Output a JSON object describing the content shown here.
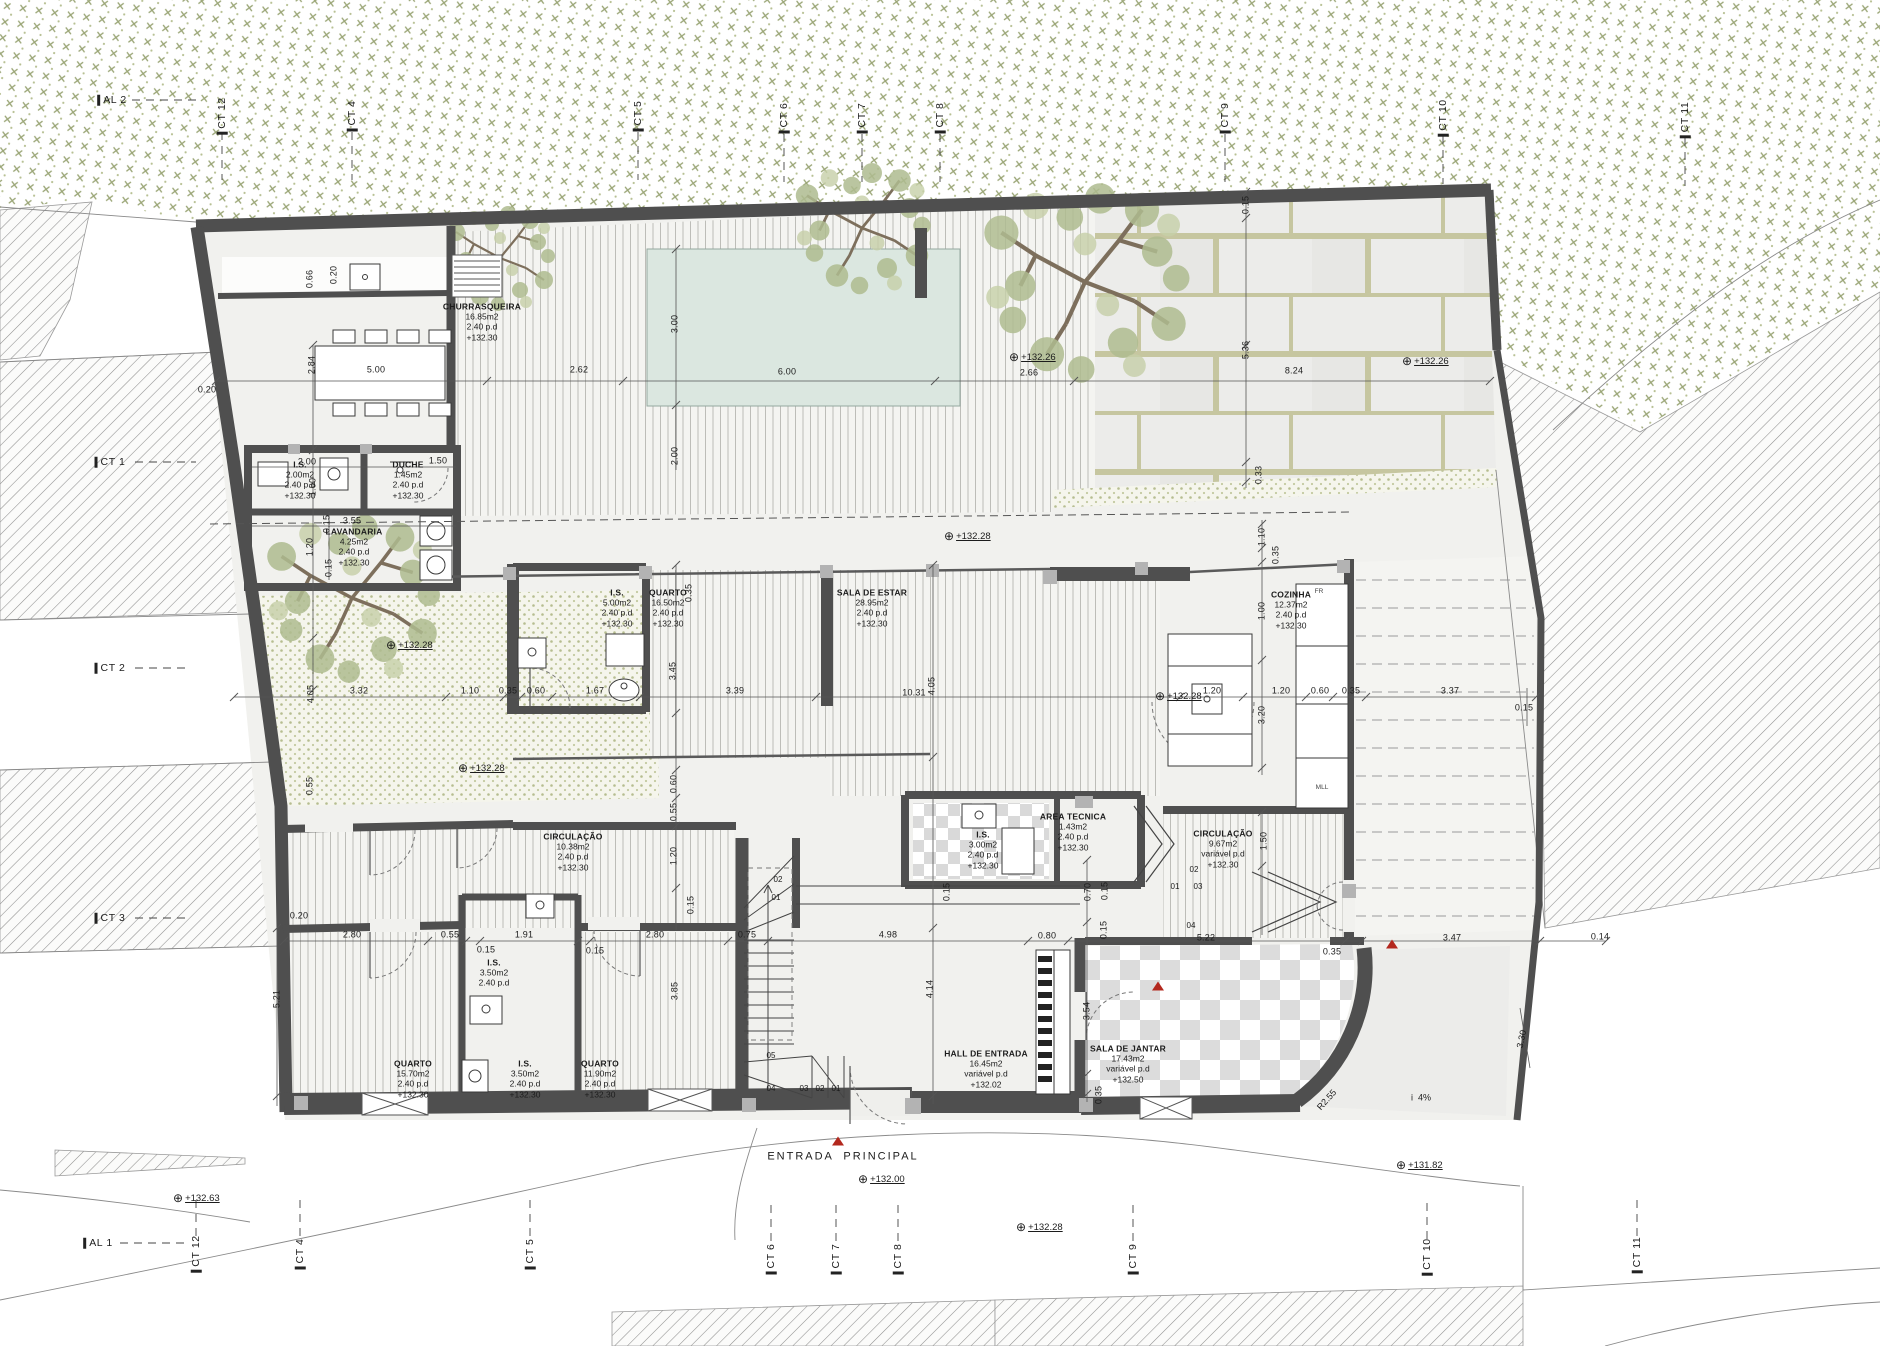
{
  "title": "Planta Piso 0 - habitação unifamiliar",
  "colors": {
    "wall": "#4f4f4f",
    "pool": "#dbe7e0",
    "leaf": "#afbc90",
    "accent_red": "#b3281e"
  },
  "rooms": [
    {
      "n": "CHURRASQUEIRA",
      "a": "16.85m2",
      "h": "2.40  p.d",
      "l": "+132.30",
      "x": 482,
      "y": 322
    },
    {
      "n": "I.S.",
      "a": "2.00m2",
      "h": "2.40  p.d",
      "l": "+132.30",
      "x": 300,
      "y": 480
    },
    {
      "n": "DUCHE",
      "a": "1.45m2",
      "h": "2.40  p.d",
      "l": "+132.30",
      "x": 408,
      "y": 480
    },
    {
      "n": "LAVANDARIA",
      "a": "4.25m2",
      "h": "2.40  p.d",
      "l": "+132.30",
      "x": 354,
      "y": 547
    },
    {
      "n": "I.S.",
      "a": "5.00m2",
      "h": "2.40  p.d",
      "l": "+132.30",
      "x": 617,
      "y": 608
    },
    {
      "n": "QUARTO",
      "a": "16.50m2",
      "h": "2.40  p.d",
      "l": "+132.30",
      "x": 668,
      "y": 608
    },
    {
      "n": "SALA DE ESTAR",
      "a": "28.95m2",
      "h": "2.40  p.d",
      "l": "+132.30",
      "x": 872,
      "y": 608
    },
    {
      "n": "COZINHA",
      "a": "12.37m2",
      "h": "2.40  p.d",
      "l": "+132.30",
      "x": 1291,
      "y": 610
    },
    {
      "n": "CIRCULAÇÃO",
      "a": "10.38m2",
      "h": "2.40  p.d",
      "l": "+132.30",
      "x": 573,
      "y": 852
    },
    {
      "n": "I.S.",
      "a": "3.00m2",
      "h": "2.40  p.d",
      "l": "+132.30",
      "x": 983,
      "y": 850
    },
    {
      "n": "AREA TECNICA",
      "a": "1.43m2",
      "h": "2.40  p.d",
      "l": "+132.30",
      "x": 1073,
      "y": 832
    },
    {
      "n": "CIRCULAÇÃO",
      "a": "9.67m2",
      "h": "variável  p.d",
      "l": "+132.30",
      "x": 1223,
      "y": 849
    },
    {
      "n": "QUARTO",
      "a": "15.70m2",
      "h": "2.40  p.d",
      "l": "+132.30",
      "x": 413,
      "y": 1079
    },
    {
      "n": "I.S.",
      "a": "3.50m2",
      "h": "2.40  p.d",
      "l": "+132.30",
      "x": 525,
      "y": 1079
    },
    {
      "n": "I.S.",
      "a": "3.50m2",
      "h": "2.40  p.d",
      "l": "",
      "x": 494,
      "y": 973
    },
    {
      "n": "QUARTO",
      "a": "11.90m2",
      "h": "2.40  p.d",
      "l": "+132.30",
      "x": 600,
      "y": 1079
    },
    {
      "n": "HALL DE ENTRADA",
      "a": "16.45m2",
      "h": "variável  p.d",
      "l": "+132.02",
      "x": 986,
      "y": 1069
    },
    {
      "n": "SALA DE JANTAR",
      "a": "17.43m2",
      "h": "variável  p.d",
      "l": "+132.50",
      "x": 1128,
      "y": 1064
    }
  ],
  "dims": [
    {
      "t": "0.20",
      "x": 207,
      "y": 390
    },
    {
      "t": "5.00",
      "x": 376,
      "y": 370
    },
    {
      "t": "2.62",
      "x": 579,
      "y": 370
    },
    {
      "t": "6.00",
      "x": 787,
      "y": 372
    },
    {
      "t": "2.66",
      "x": 1029,
      "y": 373
    },
    {
      "t": "8.24",
      "x": 1294,
      "y": 371
    },
    {
      "t": "2.84",
      "x": 312,
      "y": 365,
      "r": -90
    },
    {
      "t": "0.66",
      "x": 310,
      "y": 279,
      "r": -90
    },
    {
      "t": "0.20",
      "x": 334,
      "y": 275,
      "r": -90
    },
    {
      "t": "3.00",
      "x": 675,
      "y": 324,
      "r": -90
    },
    {
      "t": "2.00",
      "x": 675,
      "y": 456,
      "r": -90
    },
    {
      "t": "5.36",
      "x": 1246,
      "y": 350,
      "r": -90
    },
    {
      "t": "0.33",
      "x": 1259,
      "y": 475,
      "r": -90
    },
    {
      "t": "0.15",
      "x": 1246,
      "y": 205,
      "r": -90
    },
    {
      "t": "2.00",
      "x": 307,
      "y": 462
    },
    {
      "t": "1.50",
      "x": 438,
      "y": 461
    },
    {
      "t": "1.00",
      "x": 313,
      "y": 487,
      "r": -90
    },
    {
      "t": "3.55",
      "x": 352,
      "y": 521
    },
    {
      "t": "0.15",
      "x": 327,
      "y": 524,
      "r": -90
    },
    {
      "t": "1.20",
      "x": 310,
      "y": 547,
      "r": -90
    },
    {
      "t": "0.15",
      "x": 329,
      "y": 568,
      "r": -90
    },
    {
      "t": "3.32",
      "x": 359,
      "y": 691
    },
    {
      "t": "1.10",
      "x": 470,
      "y": 691
    },
    {
      "t": "0.35",
      "x": 508,
      "y": 691
    },
    {
      "t": "0.60",
      "x": 536,
      "y": 691
    },
    {
      "t": "1.67",
      "x": 595,
      "y": 691
    },
    {
      "t": "3.39",
      "x": 735,
      "y": 691
    },
    {
      "t": "10.31",
      "x": 914,
      "y": 693
    },
    {
      "t": "1.20",
      "x": 1212,
      "y": 691
    },
    {
      "t": "1.20",
      "x": 1281,
      "y": 691
    },
    {
      "t": "0.60",
      "x": 1320,
      "y": 691
    },
    {
      "t": "0.35",
      "x": 1351,
      "y": 691
    },
    {
      "t": "3.37",
      "x": 1450,
      "y": 691
    },
    {
      "t": "0.15",
      "x": 1524,
      "y": 708
    },
    {
      "t": "4.05",
      "x": 311,
      "y": 694,
      "r": -90
    },
    {
      "t": "3.45",
      "x": 673,
      "y": 671,
      "r": -90
    },
    {
      "t": "0.35",
      "x": 689,
      "y": 593,
      "r": -90
    },
    {
      "t": "4.05",
      "x": 932,
      "y": 686,
      "r": -90
    },
    {
      "t": "1.10",
      "x": 1262,
      "y": 537,
      "r": -90
    },
    {
      "t": "0.35",
      "x": 1276,
      "y": 555,
      "r": -90
    },
    {
      "t": "1.00",
      "x": 1262,
      "y": 611,
      "r": -90
    },
    {
      "t": "3.20",
      "x": 1262,
      "y": 715,
      "r": -90
    },
    {
      "t": "0.60",
      "x": 674,
      "y": 784,
      "r": -90
    },
    {
      "t": "0.55",
      "x": 674,
      "y": 812,
      "r": -90
    },
    {
      "t": "1.20",
      "x": 674,
      "y": 856,
      "r": -90
    },
    {
      "t": "0.15",
      "x": 691,
      "y": 905,
      "r": -90
    },
    {
      "t": "0.55",
      "x": 310,
      "y": 786,
      "r": -90
    },
    {
      "t": "1.50",
      "x": 1264,
      "y": 841,
      "r": -90
    },
    {
      "t": "0.70",
      "x": 1088,
      "y": 892,
      "r": -90
    },
    {
      "t": "0.15",
      "x": 947,
      "y": 892,
      "r": -90
    },
    {
      "t": "0.15",
      "x": 1105,
      "y": 891,
      "r": -90
    },
    {
      "t": "0.20",
      "x": 299,
      "y": 916
    },
    {
      "t": "2.80",
      "x": 352,
      "y": 935
    },
    {
      "t": "0.55",
      "x": 450,
      "y": 935
    },
    {
      "t": "0.15",
      "x": 486,
      "y": 950
    },
    {
      "t": "1.91",
      "x": 524,
      "y": 935
    },
    {
      "t": "0.15",
      "x": 595,
      "y": 951
    },
    {
      "t": "2.80",
      "x": 655,
      "y": 935
    },
    {
      "t": "0.75",
      "x": 747,
      "y": 935
    },
    {
      "t": "4.98",
      "x": 888,
      "y": 935
    },
    {
      "t": "0.80",
      "x": 1047,
      "y": 936
    },
    {
      "t": "5.22",
      "x": 1206,
      "y": 938
    },
    {
      "t": "0.35",
      "x": 1332,
      "y": 952
    },
    {
      "t": "3.47",
      "x": 1452,
      "y": 938
    },
    {
      "t": "0.14",
      "x": 1600,
      "y": 937
    },
    {
      "t": "5.21",
      "x": 277,
      "y": 999,
      "r": -90
    },
    {
      "t": "3.85",
      "x": 675,
      "y": 991,
      "r": -90
    },
    {
      "t": "4.14",
      "x": 930,
      "y": 989,
      "r": -90
    },
    {
      "t": "3.54",
      "x": 1087,
      "y": 1011,
      "r": -90
    },
    {
      "t": "0.35",
      "x": 1099,
      "y": 1095,
      "r": -90
    },
    {
      "t": "0.15",
      "x": 1104,
      "y": 930,
      "r": -90
    },
    {
      "t": "3.30",
      "x": 1522,
      "y": 1039,
      "r": -78
    }
  ],
  "levels": [
    {
      "t": "+132.26",
      "x": 1009,
      "y": 357
    },
    {
      "t": "+132.26",
      "x": 1402,
      "y": 361
    },
    {
      "t": "+132.28",
      "x": 944,
      "y": 536
    },
    {
      "t": "+132.28",
      "x": 458,
      "y": 768
    },
    {
      "t": "+132.28",
      "x": 386,
      "y": 645
    },
    {
      "t": "+132.28",
      "x": 1155,
      "y": 696
    },
    {
      "t": "+132.63",
      "x": 173,
      "y": 1198
    },
    {
      "t": "+132.00",
      "x": 858,
      "y": 1179
    },
    {
      "t": "+132.28",
      "x": 1016,
      "y": 1227
    },
    {
      "t": "+131.82",
      "x": 1396,
      "y": 1165
    }
  ],
  "grids": [
    {
      "t": "AL 2",
      "x": 112,
      "y": 100
    },
    {
      "t": "CT 12",
      "x": 222,
      "y": 116,
      "r": -90
    },
    {
      "t": "CT 4",
      "x": 352,
      "y": 116,
      "r": -90
    },
    {
      "t": "CT 5",
      "x": 638,
      "y": 116,
      "r": -90
    },
    {
      "t": "CT 6",
      "x": 784,
      "y": 118,
      "r": -90
    },
    {
      "t": "CT 7",
      "x": 862,
      "y": 118,
      "r": -90
    },
    {
      "t": "CT 8",
      "x": 940,
      "y": 118,
      "r": -90
    },
    {
      "t": "CT 9",
      "x": 1225,
      "y": 118,
      "r": -90
    },
    {
      "t": "CT 10",
      "x": 1443,
      "y": 118,
      "r": -90
    },
    {
      "t": "CT 11",
      "x": 1685,
      "y": 120,
      "r": -90
    },
    {
      "t": "AL 1",
      "x": 98,
      "y": 1243
    },
    {
      "t": "CT 12",
      "x": 196,
      "y": 1254,
      "r": -90
    },
    {
      "t": "CT 4",
      "x": 300,
      "y": 1254,
      "r": -90
    },
    {
      "t": "CT 5",
      "x": 530,
      "y": 1254,
      "r": -90
    },
    {
      "t": "CT 6",
      "x": 771,
      "y": 1259,
      "r": -90
    },
    {
      "t": "CT 7",
      "x": 836,
      "y": 1259,
      "r": -90
    },
    {
      "t": "CT 8",
      "x": 898,
      "y": 1259,
      "r": -90
    },
    {
      "t": "CT 9",
      "x": 1133,
      "y": 1259,
      "r": -90
    },
    {
      "t": "CT 10",
      "x": 1427,
      "y": 1257,
      "r": -90
    },
    {
      "t": "CT 11",
      "x": 1637,
      "y": 1255,
      "r": -90
    },
    {
      "t": "CT 1",
      "x": 110,
      "y": 462
    },
    {
      "t": "CT 2",
      "x": 110,
      "y": 668
    },
    {
      "t": "CT 3",
      "x": 110,
      "y": 918
    }
  ],
  "annos": [
    {
      "t": "ENTRADA  PRINCIPAL",
      "x": 843,
      "y": 1157,
      "c": "entr"
    },
    {
      "t": "i  4%",
      "x": 1421,
      "y": 1098,
      "c": "mid"
    },
    {
      "t": "R2.55",
      "x": 1327,
      "y": 1100,
      "r": -48,
      "c": "mid"
    },
    {
      "t": "FR",
      "x": 1319,
      "y": 592,
      "c": "tinylab"
    },
    {
      "t": "MLL",
      "x": 1322,
      "y": 788,
      "c": "tinylab"
    },
    {
      "t": "05",
      "x": 771,
      "y": 1056
    },
    {
      "t": "04",
      "x": 771,
      "y": 1089
    },
    {
      "t": "03",
      "x": 804,
      "y": 1089
    },
    {
      "t": "02",
      "x": 820,
      "y": 1089
    },
    {
      "t": "01",
      "x": 836,
      "y": 1089
    },
    {
      "t": "01",
      "x": 776,
      "y": 898
    },
    {
      "t": "02",
      "x": 778,
      "y": 880
    },
    {
      "t": "01",
      "x": 1175,
      "y": 887
    },
    {
      "t": "03",
      "x": 1198,
      "y": 887
    },
    {
      "t": "02",
      "x": 1194,
      "y": 870
    },
    {
      "t": "04",
      "x": 1191,
      "y": 926
    }
  ],
  "triangles": [
    {
      "x": 838,
      "y": 1141
    },
    {
      "x": 1158,
      "y": 986
    },
    {
      "x": 1392,
      "y": 944
    }
  ]
}
